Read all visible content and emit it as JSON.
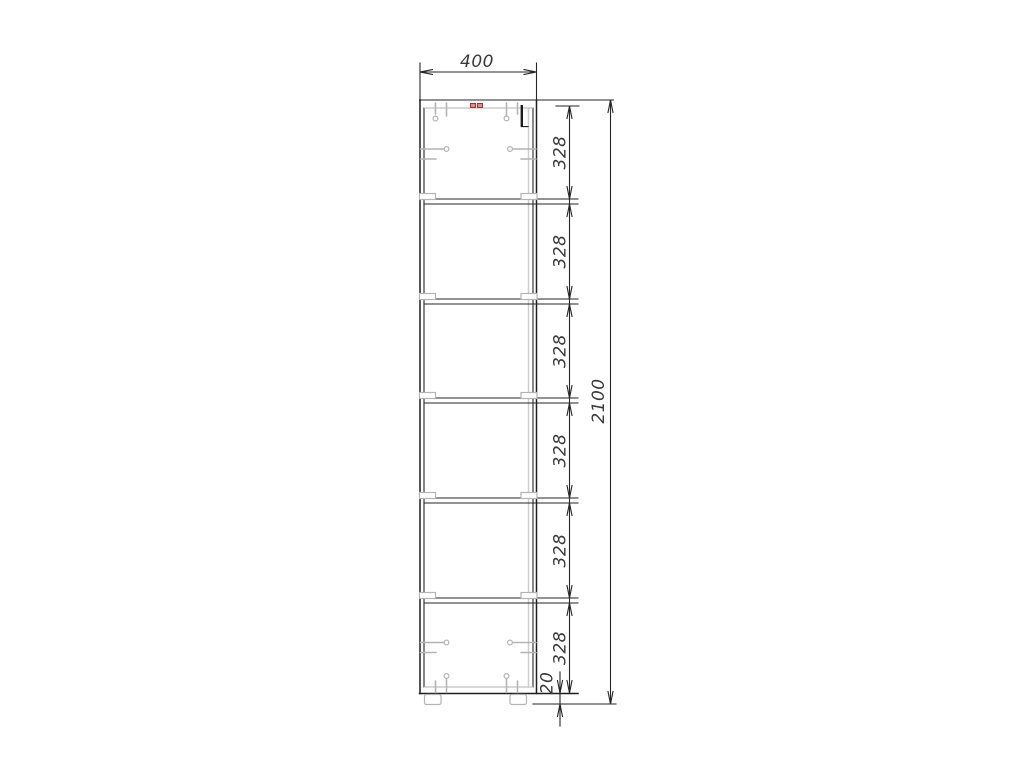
{
  "dimensions": {
    "width": "400",
    "overall_height": "2100",
    "base": "20",
    "openings": [
      "328",
      "328",
      "328",
      "328",
      "328",
      "328"
    ]
  },
  "colors": {
    "background": "#ffffff",
    "line": "#262626",
    "dimension_text": "#3a3a3a",
    "hardware": "#b4b4b4",
    "accent_red": "#a83232"
  }
}
